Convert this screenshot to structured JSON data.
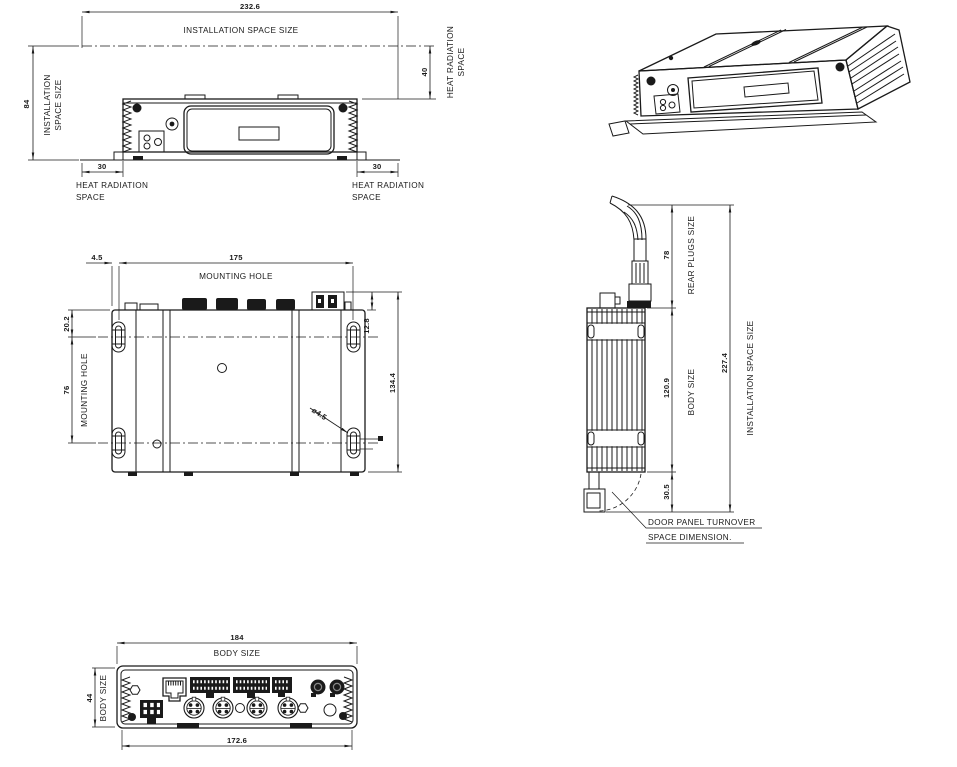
{
  "colors": {
    "ink": "#1a1a1a",
    "background": "#ffffff"
  },
  "front": {
    "dim_width": "232.6",
    "width_note": "INSTALLATION  SPACE  SIZE",
    "dim_height": "84",
    "height_note1": "INSTALLATION",
    "height_note2": "SPACE SIZE",
    "dim_heat_top": "40",
    "heat_top_note1": "HEAT RADIATION",
    "heat_top_note2": "SPACE",
    "dim_heat_left": "30",
    "heat_left_note1": "HEAT  RADIATION",
    "heat_left_note2": "SPACE",
    "dim_heat_right": "30",
    "heat_right_note1": "HEAT  RADIATION",
    "heat_right_note2": "SPACE"
  },
  "top": {
    "dim_edge_offset": "4.5",
    "dim_hole_span": "175",
    "hole_span_note": "MOUNTING  HOLE",
    "dim_hole_top_offset": "20.2",
    "dim_hole_vspan": "76",
    "hole_vspan_note": "MOUNTING  HOLE",
    "dim_plug_protrusion": "12.8",
    "dim_total_depth": "134.4",
    "hole_diameter": "ø4.5"
  },
  "side": {
    "dim_rear_plugs": "78",
    "rear_plugs_note": "REAR  PLUGS  SIZE",
    "dim_body": "120.9",
    "body_note": "BODY  SIZE",
    "dim_door_space": "30.5",
    "dim_total": "227.4",
    "total_note": "INSTALLATION  SPACE  SIZE",
    "door_note1": "DOOR  PANEL  TURNOVER",
    "door_note2": "SPACE  DIMENSION."
  },
  "rear": {
    "dim_width": "184",
    "width_note": "BODY  SIZE",
    "dim_height": "44",
    "height_note": "BODY SIZE",
    "dim_mount_span": "172.6"
  }
}
